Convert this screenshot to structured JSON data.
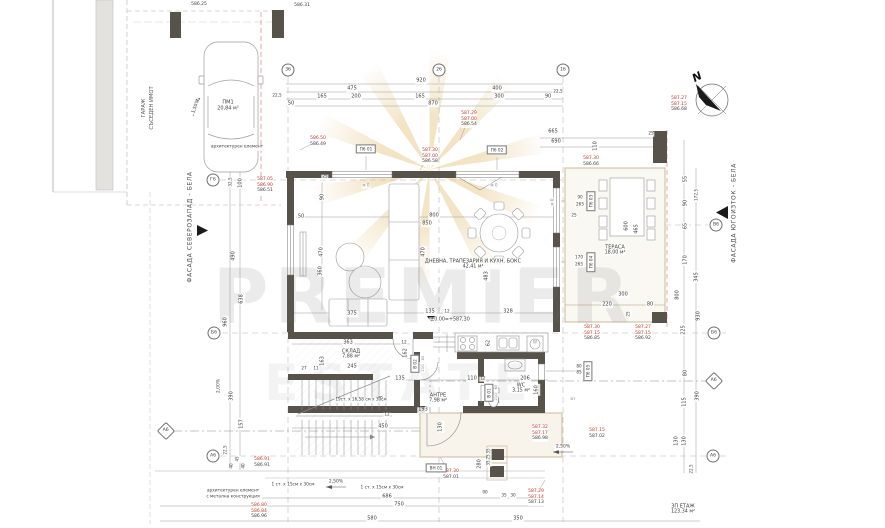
{
  "watermark": {
    "line1": "PREMIER",
    "line2": "ESTATE"
  },
  "north": {
    "label": "N"
  },
  "facades": {
    "left": "ФАСАДА СЕВЕРОЗАПАД - БЕЛА",
    "right": "ФАСАДА ЮГОИЗТОК - БЕЛА"
  },
  "garage": {
    "title": "ГАРАЖ",
    "subtitle": "СЪСЕДЕН ИМОТ"
  },
  "level_mark": "±0.00=+587,30",
  "colors": {
    "wall": "#57524a",
    "red": "#c0392b",
    "gold": "#d6a43c",
    "slab": "#cbb99a"
  },
  "room_labels": [
    {
      "name": "ДНЕВНА, ТРАПЕЗАРИЯ И КУХН. БОКС",
      "area": "42,41 м²",
      "x": 473,
      "y": 264
    },
    {
      "name": "ТЕРАСА",
      "area": "18,00 м²",
      "x": 615,
      "y": 250
    },
    {
      "name": "СКЛАД",
      "area": "7,88 м²",
      "x": 351,
      "y": 354
    },
    {
      "name": "АНТРЕ",
      "area": "7,98 м²",
      "x": 438,
      "y": 398
    },
    {
      "name": "WC",
      "area": "3,15 м²",
      "x": 521,
      "y": 388
    },
    {
      "name": "ЗП ЕТАЖ",
      "area": "123,34 м²",
      "x": 683,
      "y": 509
    }
  ],
  "grid_bubbles": [
    {
      "t": "3б",
      "x": 288,
      "y": 70
    },
    {
      "t": "2б",
      "x": 439,
      "y": 70
    },
    {
      "t": "1б",
      "x": 563,
      "y": 70
    },
    {
      "t": "Г6",
      "x": 213,
      "y": 180
    },
    {
      "t": "Б6",
      "x": 214,
      "y": 333
    },
    {
      "t": "А6",
      "x": 213,
      "y": 456
    },
    {
      "t": "В6",
      "x": 716,
      "y": 225
    },
    {
      "t": "Б6",
      "x": 714,
      "y": 333
    },
    {
      "t": "А6",
      "x": 713,
      "y": 456
    },
    {
      "t": "А6",
      "x": 166,
      "y": 431,
      "d": 1
    },
    {
      "t": "А6",
      "x": 714,
      "y": 381,
      "d": 1
    }
  ],
  "opening_tags": [
    {
      "t": "П6 01",
      "x": 366,
      "y": 149
    },
    {
      "t": "П6 02",
      "x": 497,
      "y": 150
    },
    {
      "t": "П6 03",
      "x": 591,
      "y": 201,
      "r": 1
    },
    {
      "t": "П6 04",
      "x": 591,
      "y": 262,
      "r": 1
    },
    {
      "t": "П6 05",
      "x": 588,
      "y": 371,
      "r": 1
    },
    {
      "t": "В 02",
      "x": 415,
      "y": 364,
      "r": 1
    },
    {
      "t": "В 01",
      "x": 489,
      "y": 393,
      "r": 1
    },
    {
      "t": "ВН 01",
      "x": 436,
      "y": 468
    }
  ],
  "elev_stacks": [
    {
      "x": 318,
      "y": 136,
      "lines": [
        {
          "t": "586.50",
          "c": "red"
        },
        {
          "t": "586.49",
          "c": "k"
        }
      ]
    },
    {
      "x": 469,
      "y": 111,
      "lines": [
        {
          "t": "587.29",
          "c": "red"
        },
        {
          "t": "587.00",
          "c": "red"
        },
        {
          "t": "586.54",
          "c": "k"
        }
      ]
    },
    {
      "x": 430,
      "y": 148,
      "lines": [
        {
          "t": "587.30",
          "c": "red"
        },
        {
          "t": "587.00",
          "c": "red"
        },
        {
          "t": "586.58",
          "c": "k"
        }
      ]
    },
    {
      "x": 591,
      "y": 156,
      "lines": [
        {
          "t": "587.30",
          "c": "red"
        },
        {
          "t": "586.66",
          "c": "k"
        }
      ]
    },
    {
      "x": 265,
      "y": 177,
      "lines": [
        {
          "t": "587.05",
          "c": "red"
        },
        {
          "t": "586.90",
          "c": "red"
        },
        {
          "t": "586.51",
          "c": "k"
        }
      ]
    },
    {
      "x": 679,
      "y": 96,
      "lines": [
        {
          "t": "587.27",
          "c": "red"
        },
        {
          "t": "587.15",
          "c": "red"
        },
        {
          "t": "586.68",
          "c": "k"
        }
      ]
    },
    {
      "x": 592,
      "y": 325,
      "lines": [
        {
          "t": "587.30",
          "c": "red"
        },
        {
          "t": "587.15",
          "c": "red"
        },
        {
          "t": "586.85",
          "c": "k"
        }
      ]
    },
    {
      "x": 643,
      "y": 325,
      "lines": [
        {
          "t": "587.27",
          "c": "red"
        },
        {
          "t": "587.15",
          "c": "red"
        },
        {
          "t": "586.92",
          "c": "k"
        }
      ]
    },
    {
      "x": 540,
      "y": 425,
      "lines": [
        {
          "t": "587.32",
          "c": "red"
        },
        {
          "t": "587.17",
          "c": "red"
        },
        {
          "t": "586.98",
          "c": "k"
        }
      ]
    },
    {
      "x": 597,
      "y": 428,
      "lines": [
        {
          "t": "587.15",
          "c": "red"
        },
        {
          "t": "587.02",
          "c": "k"
        }
      ]
    },
    {
      "x": 262,
      "y": 457,
      "lines": [
        {
          "t": "586.91",
          "c": "red"
        },
        {
          "t": "586.91",
          "c": "k"
        }
      ]
    },
    {
      "x": 451,
      "y": 469,
      "lines": [
        {
          "t": "587.30",
          "c": "red"
        },
        {
          "t": "587.01",
          "c": "k"
        }
      ]
    },
    {
      "x": 536,
      "y": 489,
      "lines": [
        {
          "t": "587.29",
          "c": "red"
        },
        {
          "t": "587.14",
          "c": "red"
        },
        {
          "t": "587.13",
          "c": "k"
        }
      ]
    },
    {
      "x": 259,
      "y": 503,
      "lines": [
        {
          "t": "586.80",
          "c": "red"
        },
        {
          "t": "586.84",
          "c": "red"
        },
        {
          "t": "586.96",
          "c": "k"
        }
      ]
    },
    {
      "x": 199,
      "y": 2,
      "lines": [
        {
          "t": "586.25",
          "c": "k"
        }
      ]
    },
    {
      "x": 302,
      "y": 3,
      "lines": [
        {
          "t": "586.31",
          "c": "k"
        }
      ]
    }
  ],
  "labels": [
    {
      "t": "920",
      "x": 421,
      "y": 81
    },
    {
      "t": "475",
      "x": 352,
      "y": 89
    },
    {
      "t": "400",
      "x": 497,
      "y": 89
    },
    {
      "t": "22,5",
      "x": 277,
      "y": 96,
      "s": 4.2
    },
    {
      "t": "22,5",
      "x": 558,
      "y": 92,
      "s": 4.2
    },
    {
      "t": "165",
      "x": 322,
      "y": 97
    },
    {
      "t": "200",
      "x": 356,
      "y": 97
    },
    {
      "t": "165",
      "x": 420,
      "y": 97
    },
    {
      "t": "300",
      "x": 499,
      "y": 97
    },
    {
      "t": "90",
      "x": 548,
      "y": 97
    },
    {
      "t": "50",
      "x": 291,
      "y": 104
    },
    {
      "t": "870",
      "x": 433,
      "y": 104
    },
    {
      "t": "665",
      "x": 553,
      "y": 132
    },
    {
      "t": "690",
      "x": 556,
      "y": 142
    },
    {
      "t": "55",
      "x": 686,
      "y": 179,
      "r": -90
    },
    {
      "t": "90",
      "x": 686,
      "y": 203,
      "r": -90
    },
    {
      "t": "172,5",
      "x": 697,
      "y": 195,
      "r": -90,
      "s": 4.2
    },
    {
      "t": "65",
      "x": 686,
      "y": 226,
      "r": -90
    },
    {
      "t": "170",
      "x": 686,
      "y": 260,
      "r": -90
    },
    {
      "t": "345",
      "x": 697,
      "y": 277,
      "r": -90
    },
    {
      "t": "800",
      "x": 678,
      "y": 295,
      "r": -90
    },
    {
      "t": "225",
      "x": 684,
      "y": 330,
      "r": -90
    },
    {
      "t": "930",
      "x": 699,
      "y": 316,
      "r": -90
    },
    {
      "t": "80",
      "x": 686,
      "y": 373,
      "r": -90
    },
    {
      "t": "115",
      "x": 685,
      "y": 402,
      "r": -90
    },
    {
      "t": "390",
      "x": 698,
      "y": 396,
      "r": -90
    },
    {
      "t": "130",
      "x": 677,
      "y": 441,
      "r": -90
    },
    {
      "t": "130",
      "x": 685,
      "y": 441,
      "r": -90
    },
    {
      "t": "22,5",
      "x": 692,
      "y": 469,
      "r": -90,
      "s": 4.2
    },
    {
      "t": "32,5",
      "x": 231,
      "y": 182,
      "r": -90,
      "s": 4.2
    },
    {
      "t": "100",
      "x": 241,
      "y": 183,
      "r": -90
    },
    {
      "t": "490",
      "x": 234,
      "y": 256,
      "r": -90
    },
    {
      "t": "638",
      "x": 242,
      "y": 299,
      "r": -90
    },
    {
      "t": "960",
      "x": 226,
      "y": 322,
      "r": -90
    },
    {
      "t": "2,00%",
      "x": 220,
      "y": 386,
      "r": -90,
      "s": 4.5
    },
    {
      "t": "390",
      "x": 232,
      "y": 396,
      "r": -90
    },
    {
      "t": "157",
      "x": 242,
      "y": 424,
      "r": -90
    },
    {
      "t": "22,5",
      "x": 226,
      "y": 450,
      "r": -90,
      "s": 4.2
    },
    {
      "t": "40",
      "x": 232,
      "y": 466,
      "r": -90,
      "s": 4.2
    },
    {
      "t": "45",
      "x": 238,
      "y": 459,
      "r": -90,
      "s": 4.2
    },
    {
      "t": "40",
      "x": 244,
      "y": 466,
      "r": -90,
      "s": 4.2
    },
    {
      "t": "25",
      "x": 325,
      "y": 177,
      "s": 4.2
    },
    {
      "t": "90",
      "x": 323,
      "y": 197,
      "r": -90
    },
    {
      "t": "50",
      "x": 301,
      "y": 217
    },
    {
      "t": "470",
      "x": 322,
      "y": 252,
      "r": -90
    },
    {
      "t": "360",
      "x": 321,
      "y": 271,
      "r": -90
    },
    {
      "t": "375",
      "x": 352,
      "y": 314
    },
    {
      "t": "800",
      "x": 434,
      "y": 216
    },
    {
      "t": "850",
      "x": 427,
      "y": 224
    },
    {
      "t": "470",
      "x": 424,
      "y": 252,
      "r": -90
    },
    {
      "t": "483",
      "x": 487,
      "y": 276,
      "r": -90
    },
    {
      "t": "135",
      "x": 430,
      "y": 312
    },
    {
      "t": "12",
      "x": 447,
      "y": 312,
      "s": 4.2
    },
    {
      "t": "328",
      "x": 508,
      "y": 312
    },
    {
      "t": "25",
      "x": 574,
      "y": 216,
      "s": 4.2
    },
    {
      "t": "110",
      "x": 596,
      "y": 146,
      "r": -90
    },
    {
      "t": "25",
      "x": 651,
      "y": 134,
      "s": 4.2
    },
    {
      "t": "600",
      "x": 627,
      "y": 226,
      "r": -90
    },
    {
      "t": "465",
      "x": 637,
      "y": 229,
      "r": -90
    },
    {
      "t": "300",
      "x": 623,
      "y": 295
    },
    {
      "t": "220",
      "x": 607,
      "y": 305
    },
    {
      "t": "80",
      "x": 650,
      "y": 305
    },
    {
      "t": "25",
      "x": 629,
      "y": 314,
      "r": -90,
      "s": 4.2
    },
    {
      "t": "90",
      "x": 580,
      "y": 198,
      "s": 4.2
    },
    {
      "t": "265",
      "x": 580,
      "y": 205,
      "s": 4.2
    },
    {
      "t": "170",
      "x": 579,
      "y": 258,
      "s": 4.2
    },
    {
      "t": "265",
      "x": 579,
      "y": 265,
      "s": 4.2
    },
    {
      "t": "80",
      "x": 579,
      "y": 367,
      "s": 4.2
    },
    {
      "t": "85",
      "x": 579,
      "y": 373,
      "s": 4.2
    },
    {
      "t": "363",
      "x": 348,
      "y": 343
    },
    {
      "t": "12",
      "x": 404,
      "y": 343,
      "s": 4.2
    },
    {
      "t": "163",
      "x": 323,
      "y": 361,
      "r": -90
    },
    {
      "t": "27",
      "x": 304,
      "y": 369,
      "s": 4.2
    },
    {
      "t": "11",
      "x": 316,
      "y": 369,
      "s": 4.2
    },
    {
      "t": "245",
      "x": 352,
      "y": 367
    },
    {
      "t": "98",
      "x": 382,
      "y": 399,
      "r": -90
    },
    {
      "t": "450",
      "x": 383,
      "y": 427
    },
    {
      "t": "12",
      "x": 387,
      "y": 415,
      "s": 4.2
    },
    {
      "t": "130",
      "x": 441,
      "y": 427,
      "r": -90
    },
    {
      "t": "193",
      "x": 423,
      "y": 410
    },
    {
      "t": "135",
      "x": 400,
      "y": 379
    },
    {
      "t": "162",
      "x": 406,
      "y": 353,
      "r": -90
    },
    {
      "t": "110",
      "x": 472,
      "y": 379
    },
    {
      "t": "12",
      "x": 483,
      "y": 379,
      "s": 4.2
    },
    {
      "t": "62",
      "x": 489,
      "y": 343,
      "r": -90
    },
    {
      "t": "206",
      "x": 525,
      "y": 379
    },
    {
      "t": "160",
      "x": 537,
      "y": 390,
      "r": -90
    },
    {
      "t": "280",
      "x": 480,
      "y": 464,
      "r": -90
    },
    {
      "t": "35",
      "x": 489,
      "y": 451,
      "r": -90,
      "s": 4.2
    },
    {
      "t": "25",
      "x": 489,
      "y": 457,
      "r": -90,
      "s": 4.2
    },
    {
      "t": "35",
      "x": 489,
      "y": 463,
      "r": -90,
      "s": 4.2
    },
    {
      "t": "90",
      "x": 485,
      "y": 493,
      "s": 4.2
    },
    {
      "t": "35",
      "x": 504,
      "y": 496,
      "s": 4.2
    },
    {
      "t": "30",
      "x": 513,
      "y": 496,
      "s": 4.2
    },
    {
      "t": "686",
      "x": 387,
      "y": 497
    },
    {
      "t": "750",
      "x": 399,
      "y": 505
    },
    {
      "t": "580",
      "x": 372,
      "y": 519
    },
    {
      "t": "350",
      "x": 518,
      "y": 519
    },
    {
      "t": "ПМ1",
      "x": 228,
      "y": 103
    },
    {
      "t": "20,84 м²",
      "x": 228,
      "y": 109
    },
    {
      "t": "1,50%",
      "x": 197,
      "y": 107,
      "r": -70,
      "s": 4.5
    },
    {
      "t": "архитектурен елемент",
      "x": 237,
      "y": 148,
      "s": 4.3
    },
    {
      "t": "м 0",
      "x": 366,
      "y": 186,
      "s": 4.2,
      "c": "gray"
    },
    {
      "t": "м 0",
      "x": 494,
      "y": 186,
      "s": 4.2,
      "c": "gray"
    },
    {
      "t": "м 0",
      "x": 553,
      "y": 202,
      "r": -90,
      "s": 4.2,
      "c": "gray"
    },
    {
      "t": "ВТ",
      "x": 573,
      "y": 399,
      "s": 3.8,
      "c": "gray"
    },
    {
      "t": "W",
      "x": 535,
      "y": 343,
      "s": 4.2,
      "c": "gray"
    },
    {
      "t": "80",
      "x": 423,
      "y": 358,
      "r": -90,
      "s": 3.8,
      "c": "gray"
    },
    {
      "t": "210",
      "x": 423,
      "y": 368,
      "r": -90,
      "s": 3.8,
      "c": "gray"
    },
    {
      "t": "60",
      "x": 496,
      "y": 387,
      "r": -90,
      "s": 3.8,
      "c": "gray"
    },
    {
      "t": "210",
      "x": 496,
      "y": 397,
      "r": -90,
      "s": 3.8,
      "c": "gray"
    },
    {
      "t": "19ст. х 16,58 см х 30см",
      "x": 361,
      "y": 400,
      "s": 4.2
    },
    {
      "t": "±0.00=+587,30",
      "x": 450,
      "y": 320,
      "s": 4.8
    },
    {
      "t": "1 ст. х 15см х 30см",
      "x": 293,
      "y": 486,
      "s": 4.3
    },
    {
      "t": "2,50%",
      "x": 336,
      "y": 483,
      "s": 4.5
    },
    {
      "t": "1 ст. х 15см х 30см",
      "x": 382,
      "y": 489,
      "s": 4.3
    },
    {
      "t": "2,50%",
      "x": 563,
      "y": 448,
      "s": 4.5
    },
    {
      "t": "архитектурен елемент",
      "x": 233,
      "y": 492,
      "s": 4.3
    },
    {
      "t": "с метална конструкция",
      "x": 233,
      "y": 498,
      "s": 4.3
    }
  ]
}
